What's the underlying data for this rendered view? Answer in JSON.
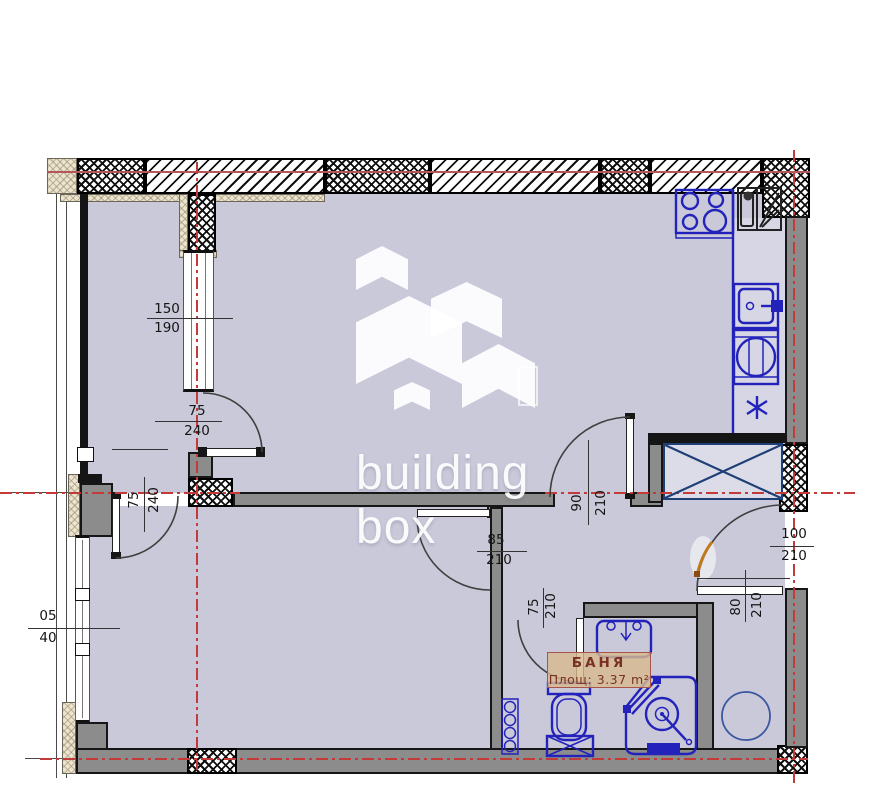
{
  "plan": {
    "bath_label": {
      "name": "БАНЯ",
      "area": "Площ: 3.37 m²"
    },
    "watermark": {
      "line1": "building",
      "line2": "box"
    },
    "dims": {
      "window_left": {
        "w": "150",
        "h": "190"
      },
      "balcony_door": {
        "w": "75",
        "h": "240"
      },
      "bedroom_left_door": {
        "w": "75",
        "h": "240"
      },
      "living_door": {
        "w": "90",
        "h": "210"
      },
      "bedroom_door": {
        "w": "85",
        "h": "210"
      },
      "entrance_door": {
        "w": "100",
        "h": "210"
      },
      "corridor_opening": {
        "w": "80",
        "h": "210"
      },
      "bath_door": {
        "w": "75",
        "h": "210"
      },
      "window_bottom": {
        "w": "05",
        "h": "40"
      }
    },
    "colors": {
      "floor": "#c9c9da",
      "counter": "#d6d6e4",
      "wall_gray": "#8c8c8c",
      "fixture_blue": "#2323bb",
      "shaft_navy": "#1f3f77",
      "axis_red": "#c23b38",
      "label_text": "#7b3026",
      "label_bg": "#d7ba8d",
      "entrance_orange": "#c07818"
    }
  }
}
